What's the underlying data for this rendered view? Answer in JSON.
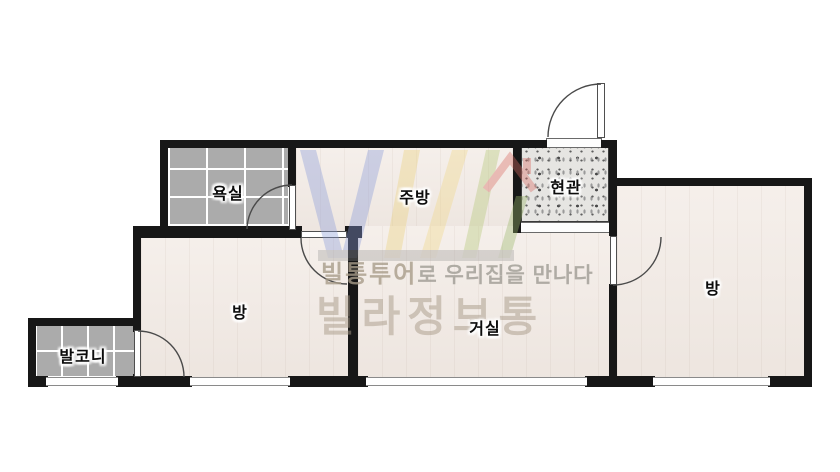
{
  "plan": {
    "type": "apartment-floor-plan",
    "rooms": {
      "bathroom": {
        "label": "욕실"
      },
      "kitchen": {
        "label": "주방"
      },
      "entrance": {
        "label": "현관"
      },
      "room_right": {
        "label": "방"
      },
      "room_left": {
        "label": "방"
      },
      "living": {
        "label": "거실"
      },
      "balcony": {
        "label": "발코니"
      }
    }
  },
  "watermark": {
    "logo": "VL-house-logo",
    "tagline_brand": "빌통투어",
    "tagline_rest": "로 우리집을 만나다",
    "brand_large": "빌라정보통"
  },
  "colors": {
    "wall": "#171717",
    "wood_floor": "#f2eae4",
    "tile_floor": "#ababab",
    "entry_floor": "#e6e5e2",
    "logo_blue": "#8b9cd9",
    "logo_yellow": "#ecd27e",
    "logo_green": "#b5c878",
    "logo_red": "#d96b63",
    "watermark_text": "#a89c8a"
  }
}
